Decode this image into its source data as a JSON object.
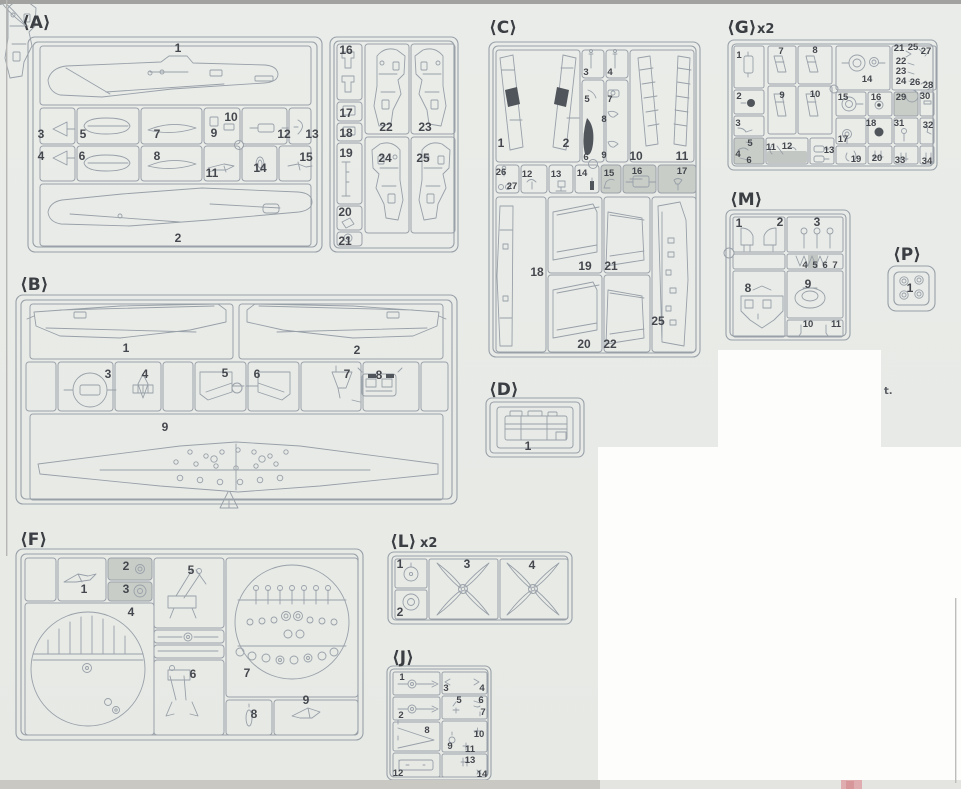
{
  "document": {
    "kind": "plastic model kit sprue parts map",
    "colors": {
      "paper": "#e9ebe8",
      "line": "#98a0a8",
      "label": "#44474d",
      "shaded_cell": "#c9cdc8",
      "dark_part_fill": "#50555b",
      "scan_bar": "#c9c8c3",
      "scan_pink": "#dfadaf"
    }
  },
  "artifacts": {
    "stray_text": "t."
  },
  "sprues": {
    "A": {
      "title": "⟨A⟩",
      "parts": [
        "1",
        "2",
        "3",
        "4",
        "5",
        "6",
        "7",
        "8",
        "9",
        "10",
        "11",
        "12",
        "13",
        "14",
        "15",
        "16",
        "17",
        "18",
        "19",
        "20",
        "21",
        "22",
        "23",
        "24",
        "25"
      ]
    },
    "B": {
      "title": "⟨B⟩",
      "parts": [
        "1",
        "2",
        "3",
        "4",
        "5",
        "6",
        "7",
        "8",
        "9"
      ]
    },
    "C": {
      "title": "⟨C⟩",
      "parts": [
        "1",
        "2",
        "3",
        "4",
        "5",
        "6",
        "7",
        "8",
        "9",
        "10",
        "11",
        "12",
        "13",
        "14",
        "15",
        "16",
        "17",
        "18",
        "19",
        "20",
        "21",
        "22",
        "25",
        "26",
        "27"
      ],
      "unused_shaded": [
        "15",
        "16",
        "17"
      ]
    },
    "D": {
      "title": "⟨D⟩",
      "parts": [
        "1"
      ]
    },
    "F": {
      "title": "⟨F⟩",
      "parts": [
        "1",
        "2",
        "3",
        "4",
        "5",
        "6",
        "7",
        "8",
        "9"
      ],
      "unused_shaded": [
        "2",
        "3"
      ]
    },
    "G": {
      "title": "⟨G⟩",
      "quantity": "x2",
      "parts": [
        "1",
        "2",
        "3",
        "4",
        "5",
        "6",
        "7",
        "8",
        "9",
        "10",
        "11",
        "12",
        "13",
        "14",
        "15",
        "16",
        "17",
        "18",
        "19",
        "20",
        "21",
        "22",
        "23",
        "24",
        "25",
        "26",
        "27",
        "28",
        "29",
        "30",
        "31",
        "32",
        "33",
        "34"
      ],
      "unused_shaded": [
        "4",
        "5",
        "6",
        "12",
        "29"
      ]
    },
    "J": {
      "title": "⟨J⟩",
      "parts": [
        "1",
        "2",
        "3",
        "4",
        "5",
        "6",
        "7",
        "8",
        "9",
        "10",
        "11",
        "12",
        "13",
        "14"
      ]
    },
    "L": {
      "title": "⟨L⟩",
      "quantity": "x2",
      "parts": [
        "1",
        "2",
        "3",
        "4"
      ]
    },
    "M": {
      "title": "⟨M⟩",
      "parts": [
        "1",
        "2",
        "3",
        "4",
        "5",
        "6",
        "7",
        "8",
        "9",
        "10",
        "11"
      ],
      "unused_shaded": [
        "5"
      ]
    },
    "P": {
      "title": "⟨P⟩",
      "parts": [
        "1"
      ]
    }
  }
}
